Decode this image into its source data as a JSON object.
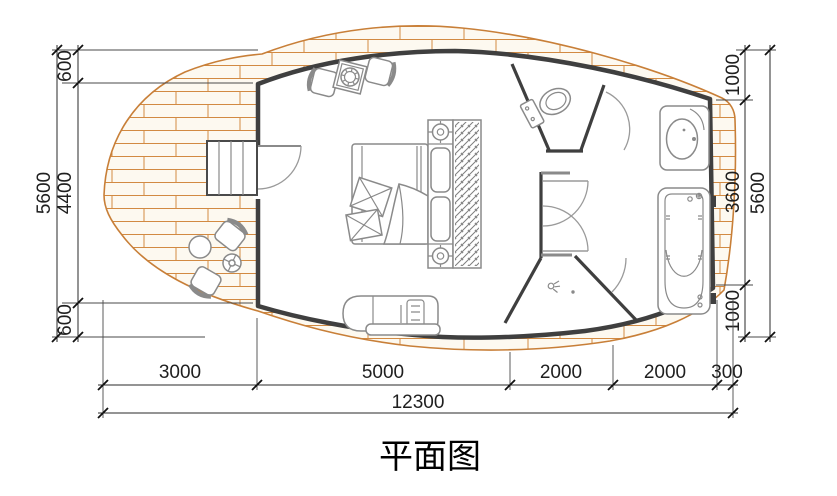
{
  "title": "平面图",
  "colors": {
    "deck_line": "#cf833c",
    "deck_fill": "#fdf9f0",
    "wall": "#3f3f3f",
    "furniture": "#8a8a8a",
    "dimension": "#1f1f1f"
  },
  "dimensions": {
    "left_chain": [
      "600",
      "4400",
      "600"
    ],
    "left_total": "5600",
    "right_chain": [
      "1000",
      "3600",
      "1000"
    ],
    "right_total": "5600",
    "bottom_chain": [
      "3000",
      "5000",
      "2000",
      "2000",
      "300"
    ],
    "bottom_total": "12300"
  }
}
